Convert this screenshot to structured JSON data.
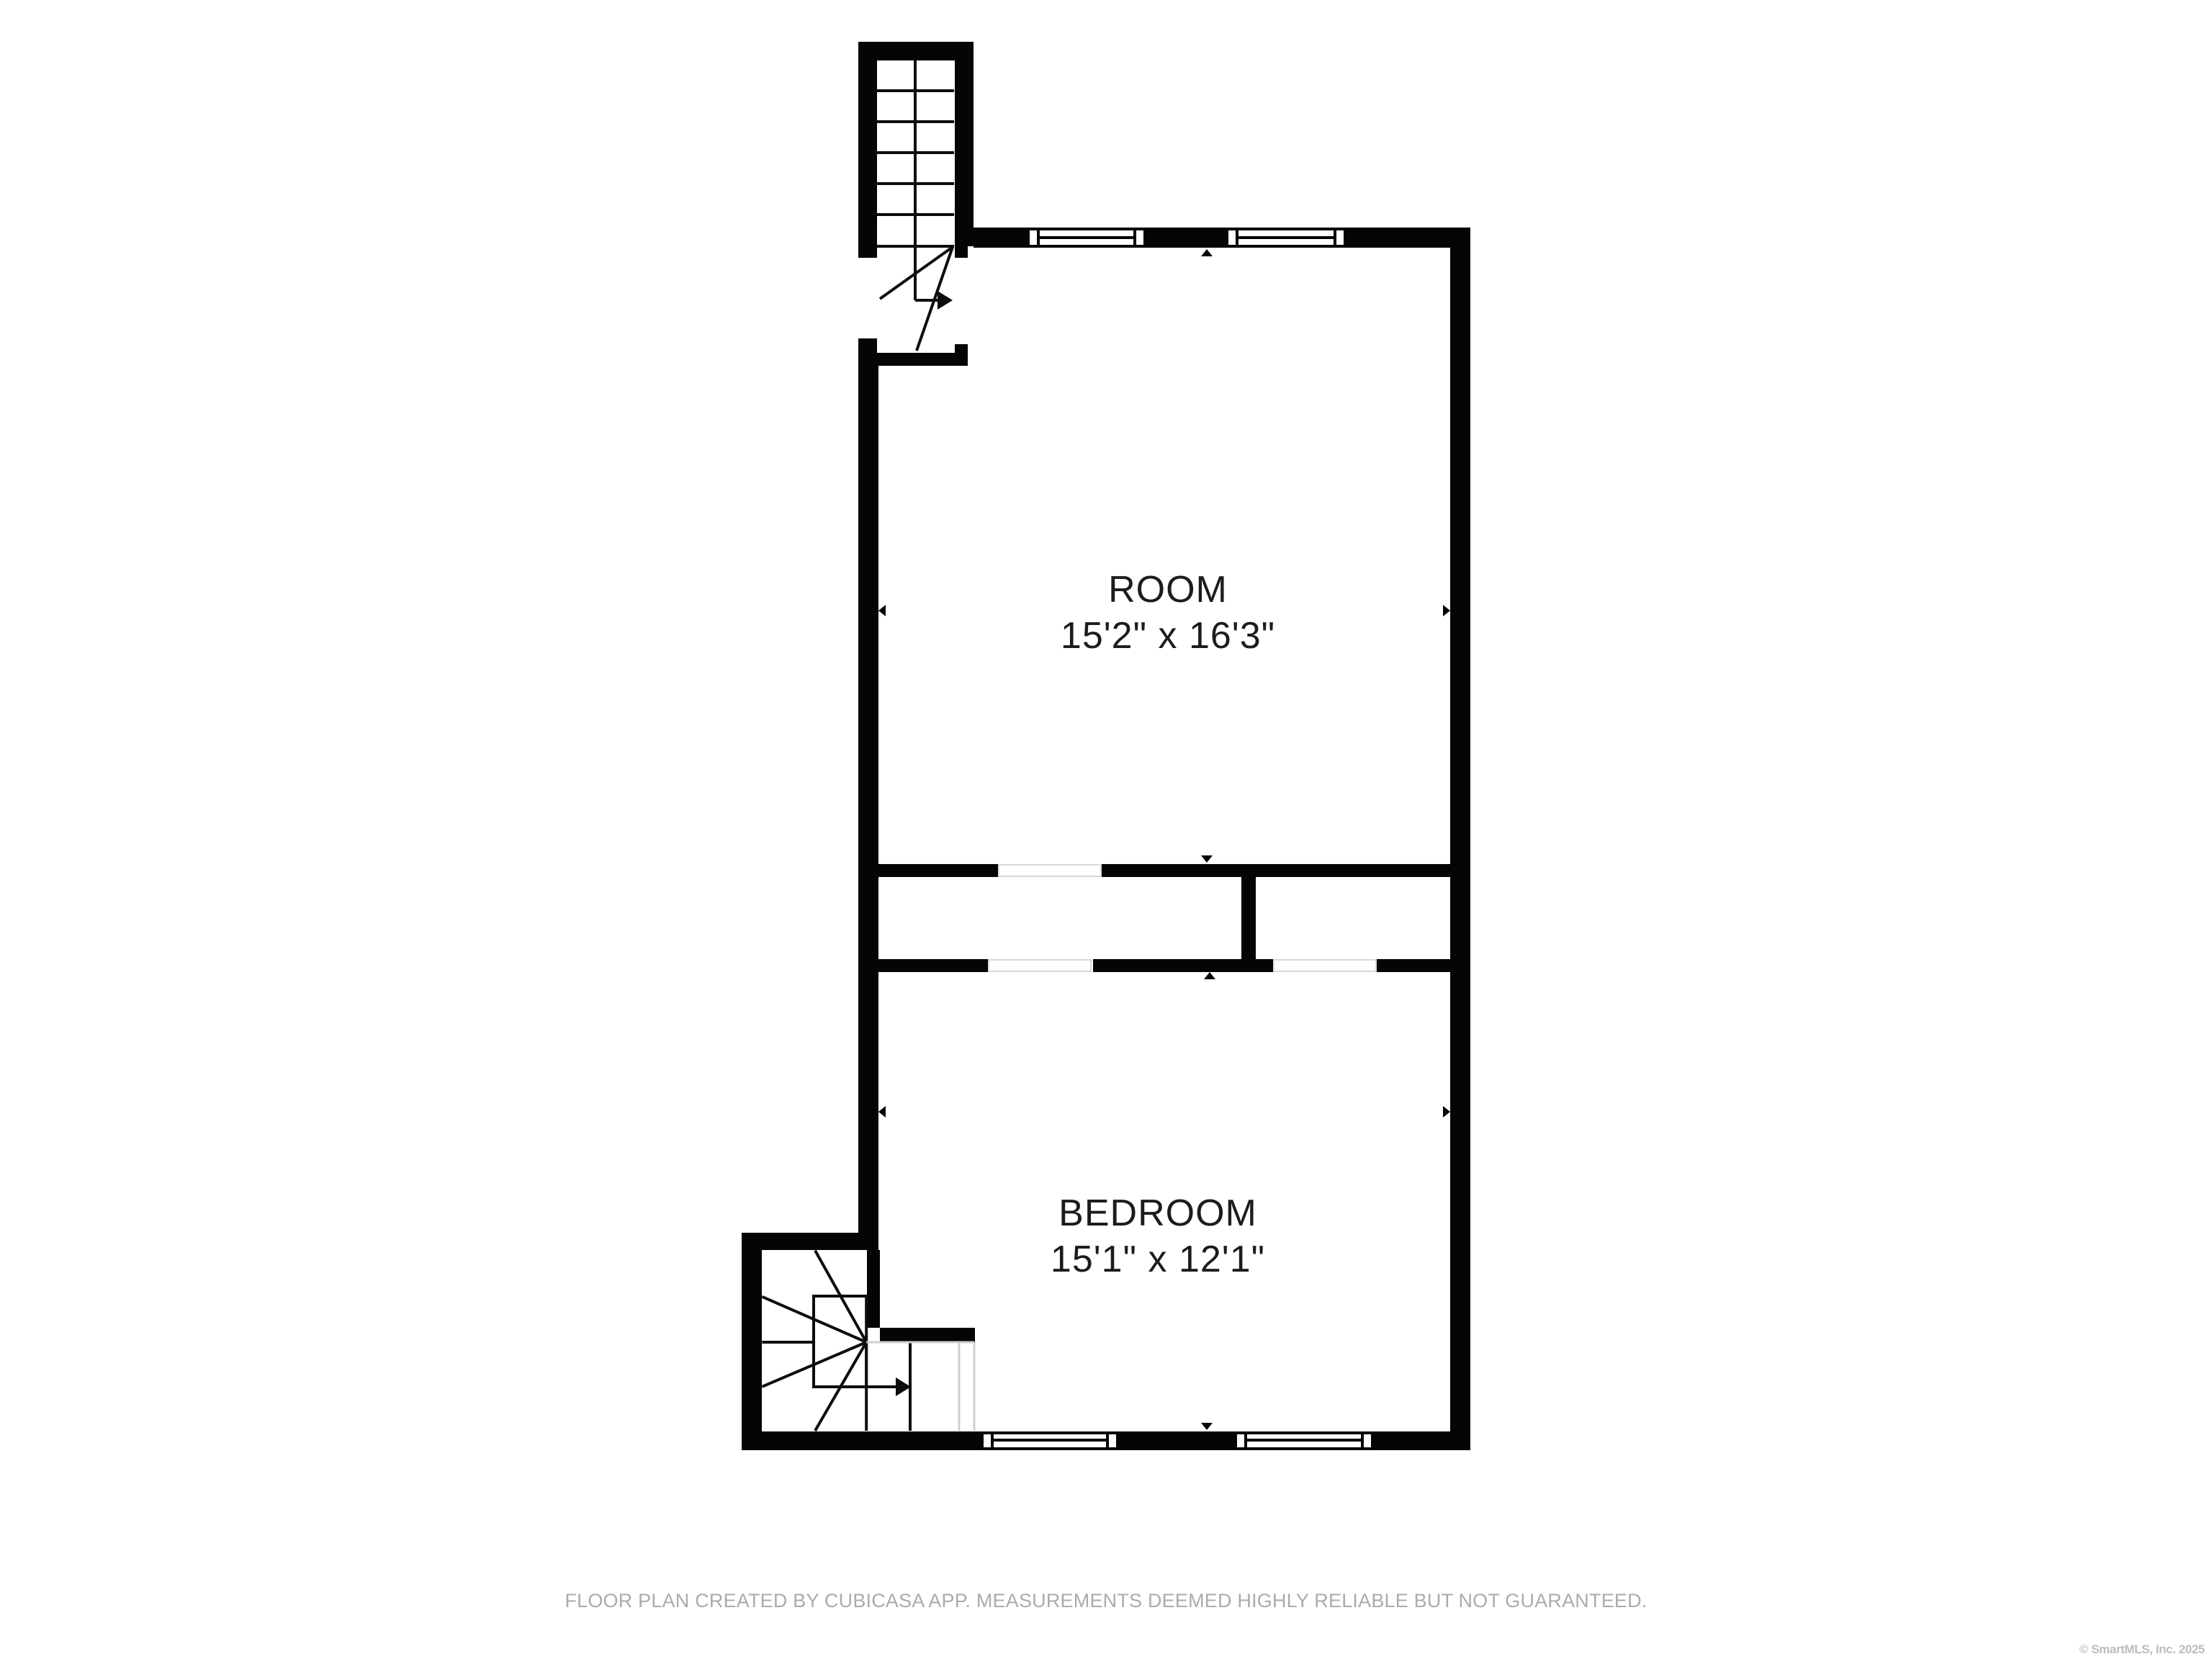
{
  "floor_plan": {
    "rooms": [
      {
        "name": "ROOM",
        "dimensions": "15'2\" x 16'3\""
      },
      {
        "name": "BEDROOM",
        "dimensions": "15'1\" x 12'1\""
      }
    ],
    "features": {
      "upper_stairs": "straight flight with winder turn, direction arrow exits right into room",
      "lower_stairs": "winder staircase at bottom-left, direction arrow exits right into bedroom",
      "windows": [
        "top-wall-window-1",
        "top-wall-window-2",
        "bottom-wall-window-1",
        "bottom-wall-window-2"
      ],
      "door_openings": [
        "hall-top-opening",
        "hall-bottom-opening-left",
        "hall-bottom-opening-right",
        "stair-landing-opening"
      ]
    },
    "disclaimer": "FLOOR PLAN CREATED BY CUBICASA APP. MEASUREMENTS DEEMED HIGHLY RELIABLE BUT NOT GUARANTEED.",
    "copyright": "© SmartMLS, Inc.  2025",
    "colors": {
      "wall": "#050505",
      "background": "#ffffff",
      "room_label": "#1c1c1c",
      "opening_border": "#d9d9d9",
      "stair_faded_line": "#cfcfcf",
      "disclaimer_text": "#ababab",
      "copyright_text": "#bdbdbd"
    }
  }
}
